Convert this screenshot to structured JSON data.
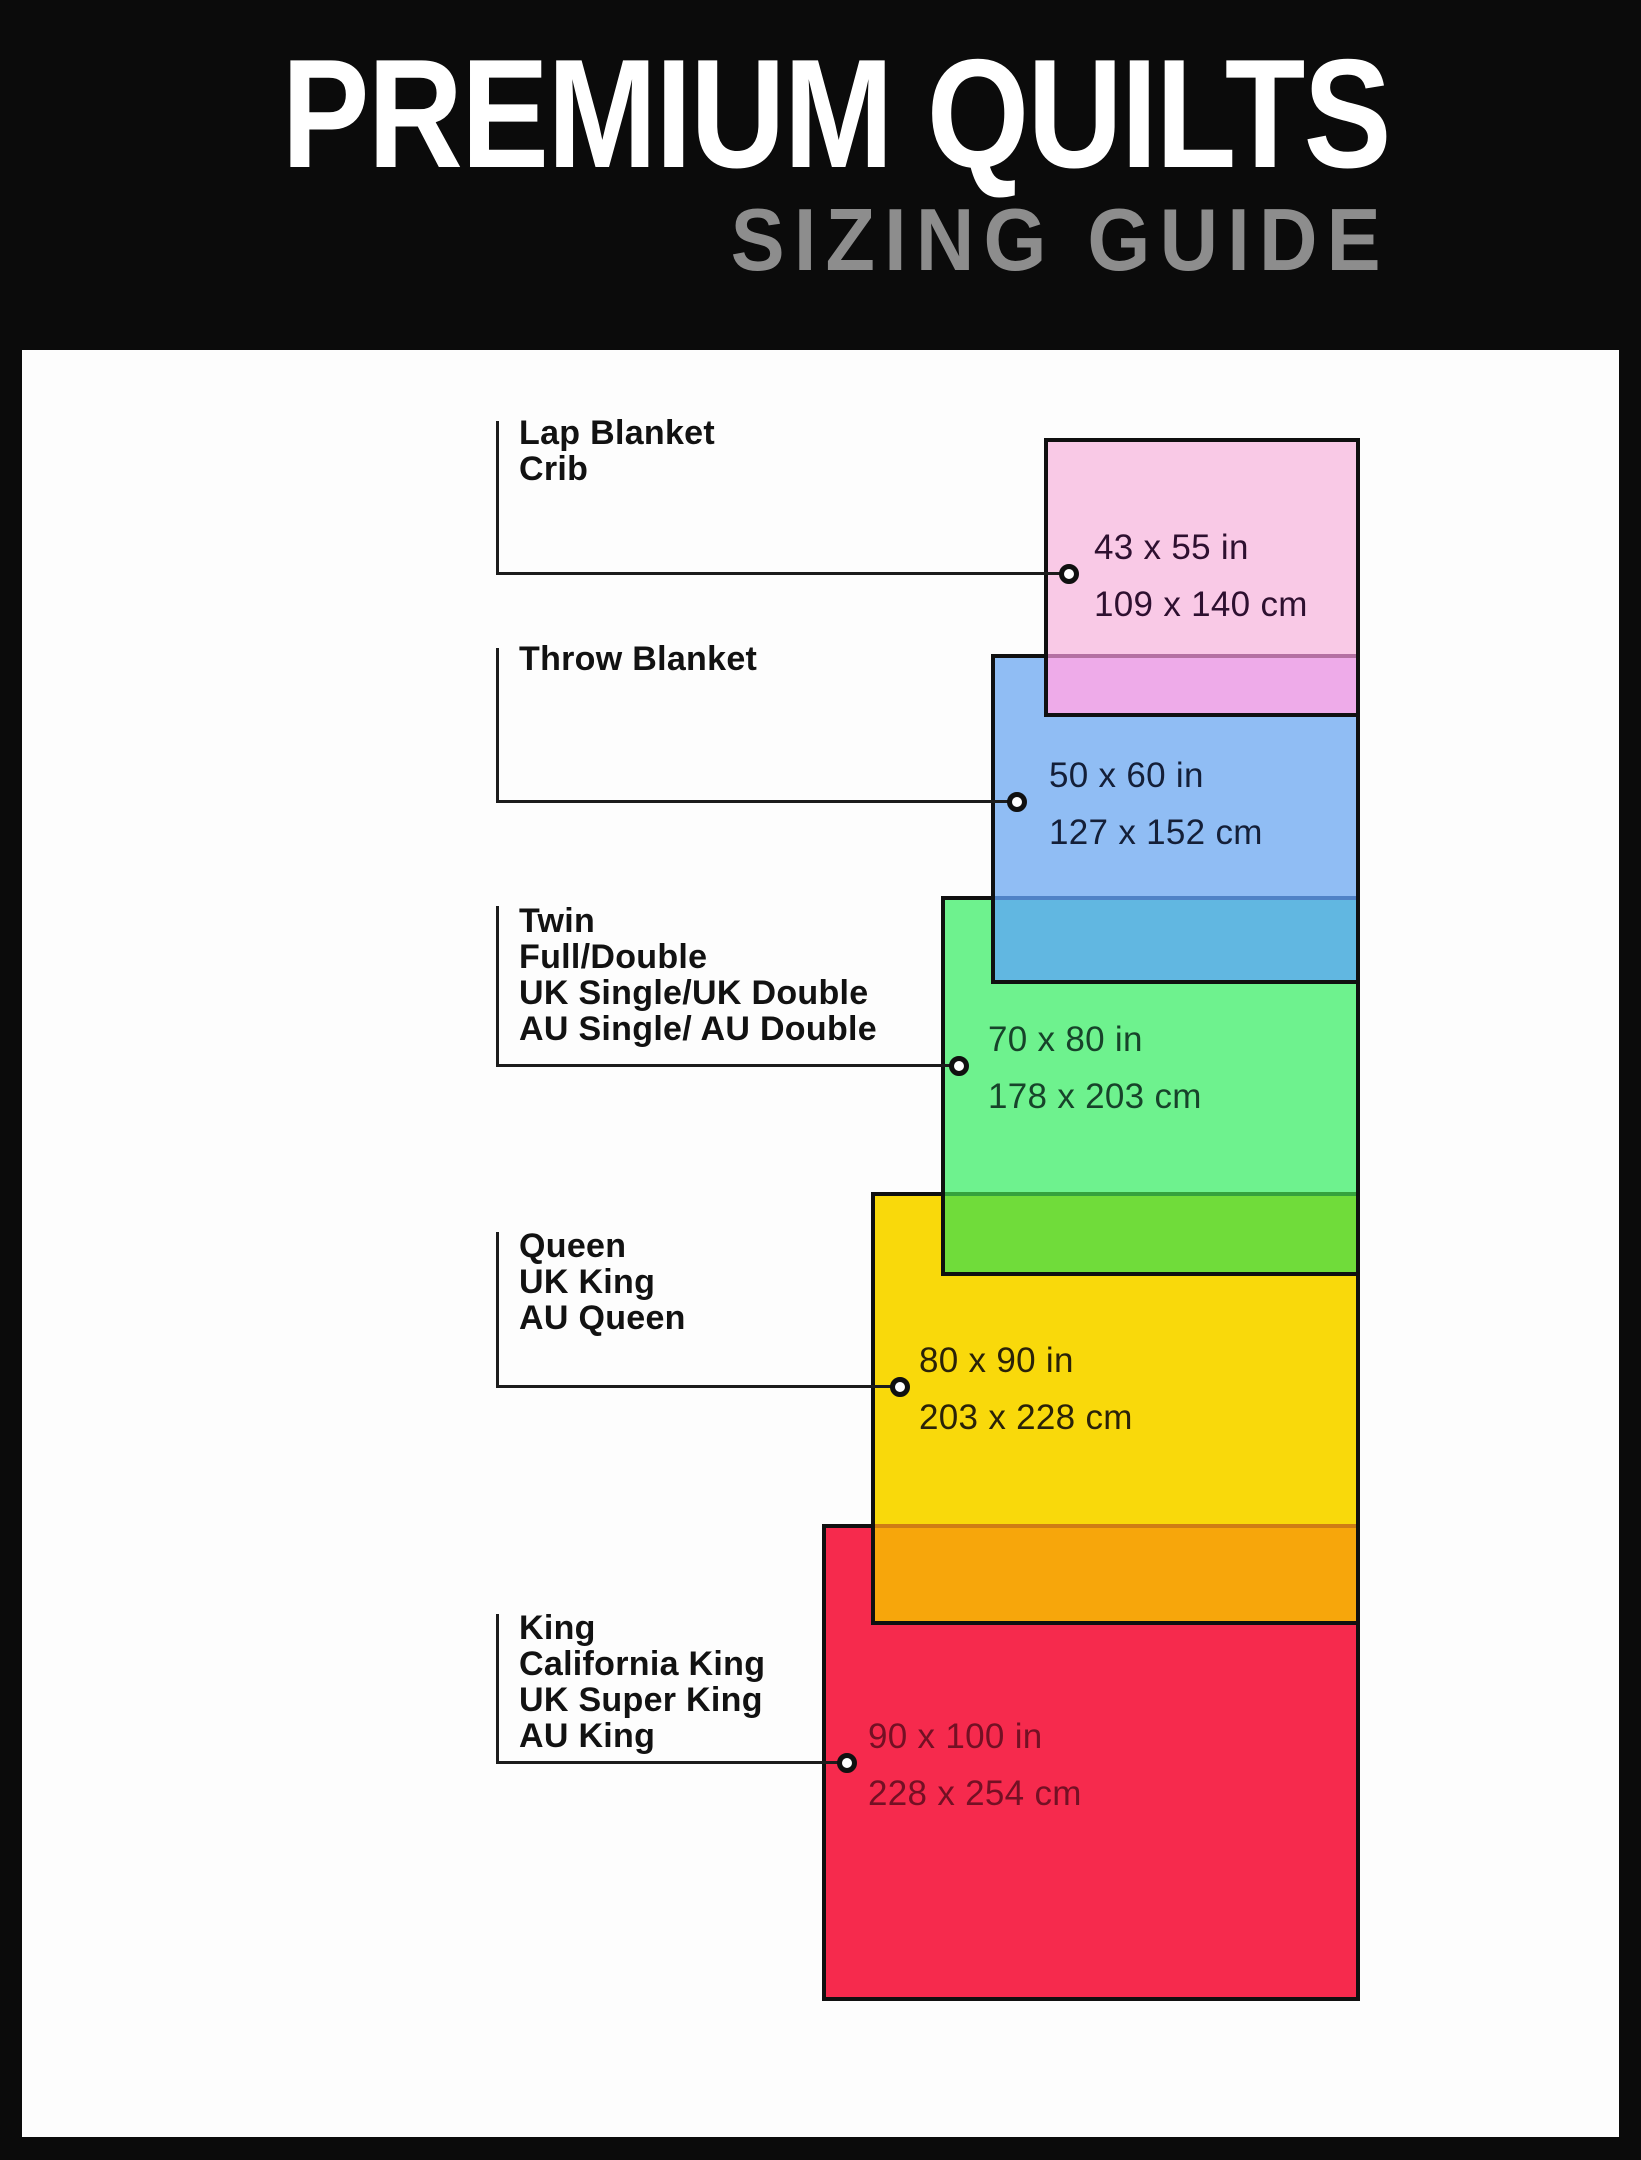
{
  "header": {
    "title": "PREMIUM QUILTS",
    "subtitle": "SIZING GUIDE"
  },
  "palette": {
    "page_bg": "#0b0b0b",
    "panel_bg": "#fdfdfd",
    "title_color": "#ffffff",
    "subtitle_color": "#8d8d8d",
    "line_color": "#1c1c1c",
    "label_color": "#121212",
    "border_color": "#101010"
  },
  "sizes": [
    {
      "id": "lap-blanket-crib",
      "labels": [
        "Lap Blanket",
        "Crib"
      ],
      "inches": "43 x 55 in",
      "cm": "109 x 140 cm",
      "fill": "#f9c9e6",
      "text_color": "#2e1030",
      "overlap_fill": "#eeabe9",
      "overlap_border": "#b470a2"
    },
    {
      "id": "throw-blanket",
      "labels": [
        "Throw Blanket"
      ],
      "inches": "50 x 60 in",
      "cm": "127 x 152 cm",
      "fill": "#90bdf4",
      "text_color": "#141f38",
      "overlap_fill": "#61b7e1",
      "overlap_border": "#4f82c6"
    },
    {
      "id": "twin-full-double",
      "labels": [
        "Twin",
        "Full/Double",
        "UK Single/UK Double",
        "AU Single/ AU Double"
      ],
      "inches": "70 x 80 in",
      "cm": "178 x 203 cm",
      "fill": "#6ef28e",
      "text_color": "#17432a",
      "overlap_fill": "#70dc3a",
      "overlap_border": "#35a23d"
    },
    {
      "id": "queen-uk-king",
      "labels": [
        "Queen",
        "UK King",
        "AU Queen"
      ],
      "inches": "80 x 90 in",
      "cm": "203 x 228 cm",
      "fill": "#f9d90b",
      "text_color": "#2a2208",
      "overlap_fill": "#f7a60b",
      "overlap_border": "#cf7d15"
    },
    {
      "id": "king-california-king",
      "labels": [
        "King",
        "California King",
        "UK Super King",
        "AU King"
      ],
      "inches": "90 x 100 in",
      "cm": "228 x 254 cm",
      "fill": "#f62a4d",
      "text_color": "#731024"
    }
  ]
}
